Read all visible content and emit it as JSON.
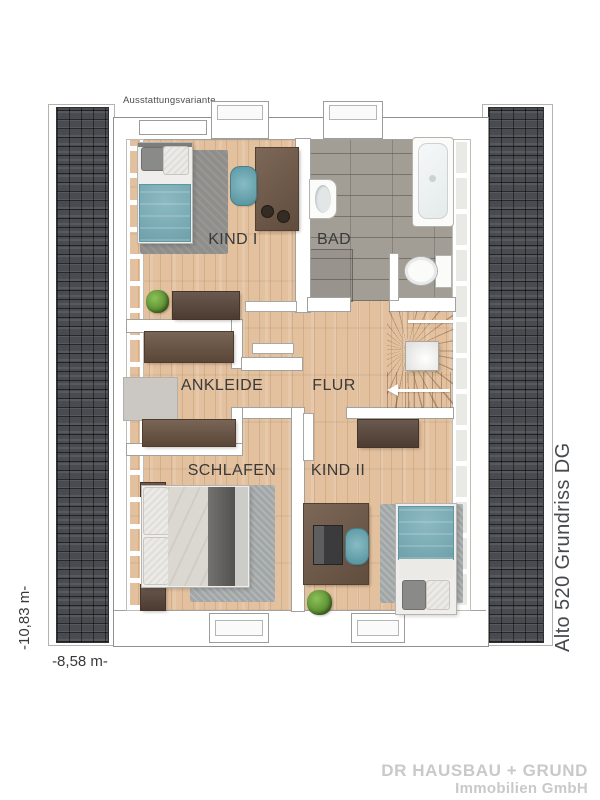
{
  "annotation": "Ausstattungsvariante",
  "rooms": [
    {
      "id": "kind1",
      "label": "KIND I"
    },
    {
      "id": "bad",
      "label": "BAD"
    },
    {
      "id": "ankleide",
      "label": "ANKLEIDE"
    },
    {
      "id": "flur",
      "label": "FLUR"
    },
    {
      "id": "schlafen",
      "label": "SCHLAFEN"
    },
    {
      "id": "kind2",
      "label": "KIND II"
    }
  ],
  "dimensions": {
    "width_label": "-8,58 m-",
    "height_label": "-10,83 m-"
  },
  "side_title": "Alto 520 Grundriss DG",
  "branding": {
    "line1": "DR HAUSBAU + GRUND",
    "line2": "Immobilien GmbH"
  },
  "colors": {
    "wood_floor": "#e3c19e",
    "bath_tile": "#a29e96",
    "roof_tile": "#4a4b51",
    "accent_teal": "#78aeb8",
    "furniture_brown": "#66503f",
    "label_text": "#3a3a3a",
    "brand_text": "#c9c9c9"
  }
}
